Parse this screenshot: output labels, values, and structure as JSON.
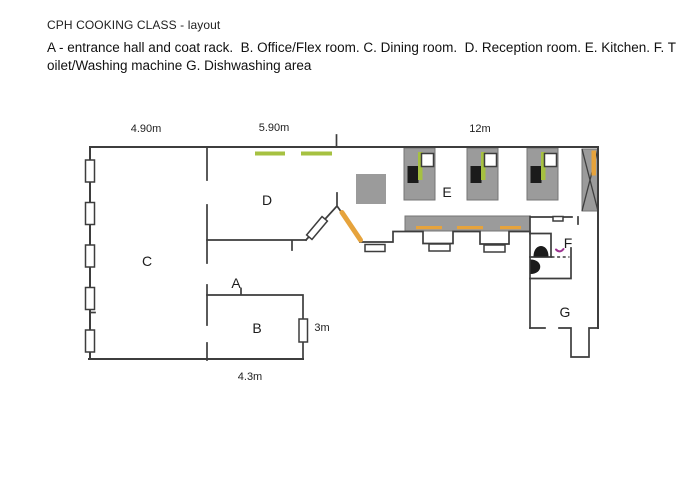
{
  "title": "CPH COOKING CLASS - layout",
  "legend": {
    "line1": "A - entrance hall and coat rack.  B. Office/Flex room. C. Dining room.  D. Reception room. E. Kitchen. F. T",
    "line2": "oilet/Washing machine G. Dishwashing area"
  },
  "room_labels": {
    "A": "A",
    "B": "B",
    "C": "C",
    "D": "D",
    "E": "E",
    "F": "F",
    "G": "G"
  },
  "room_names": {
    "A": "entrance hall and coat rack",
    "B": "Office/Flex room",
    "C": "Dining room",
    "D": "Reception room",
    "E": "Kitchen",
    "F": "Toilet/Washing machine",
    "G": "Dishwashing area"
  },
  "dimensions": {
    "c_width": "4.90m",
    "d_width": "5.90m",
    "kitchen_width": "12m",
    "b_height": "3m",
    "b_width": "4.3m"
  },
  "colors": {
    "wall": "#3d3d3d",
    "fixture_gray": "#9b9b9b",
    "fixture_black": "#1b1b1b",
    "accent_green": "#a6c141",
    "accent_orange": "#e6a33c",
    "accent_magenta": "#9c3390"
  }
}
